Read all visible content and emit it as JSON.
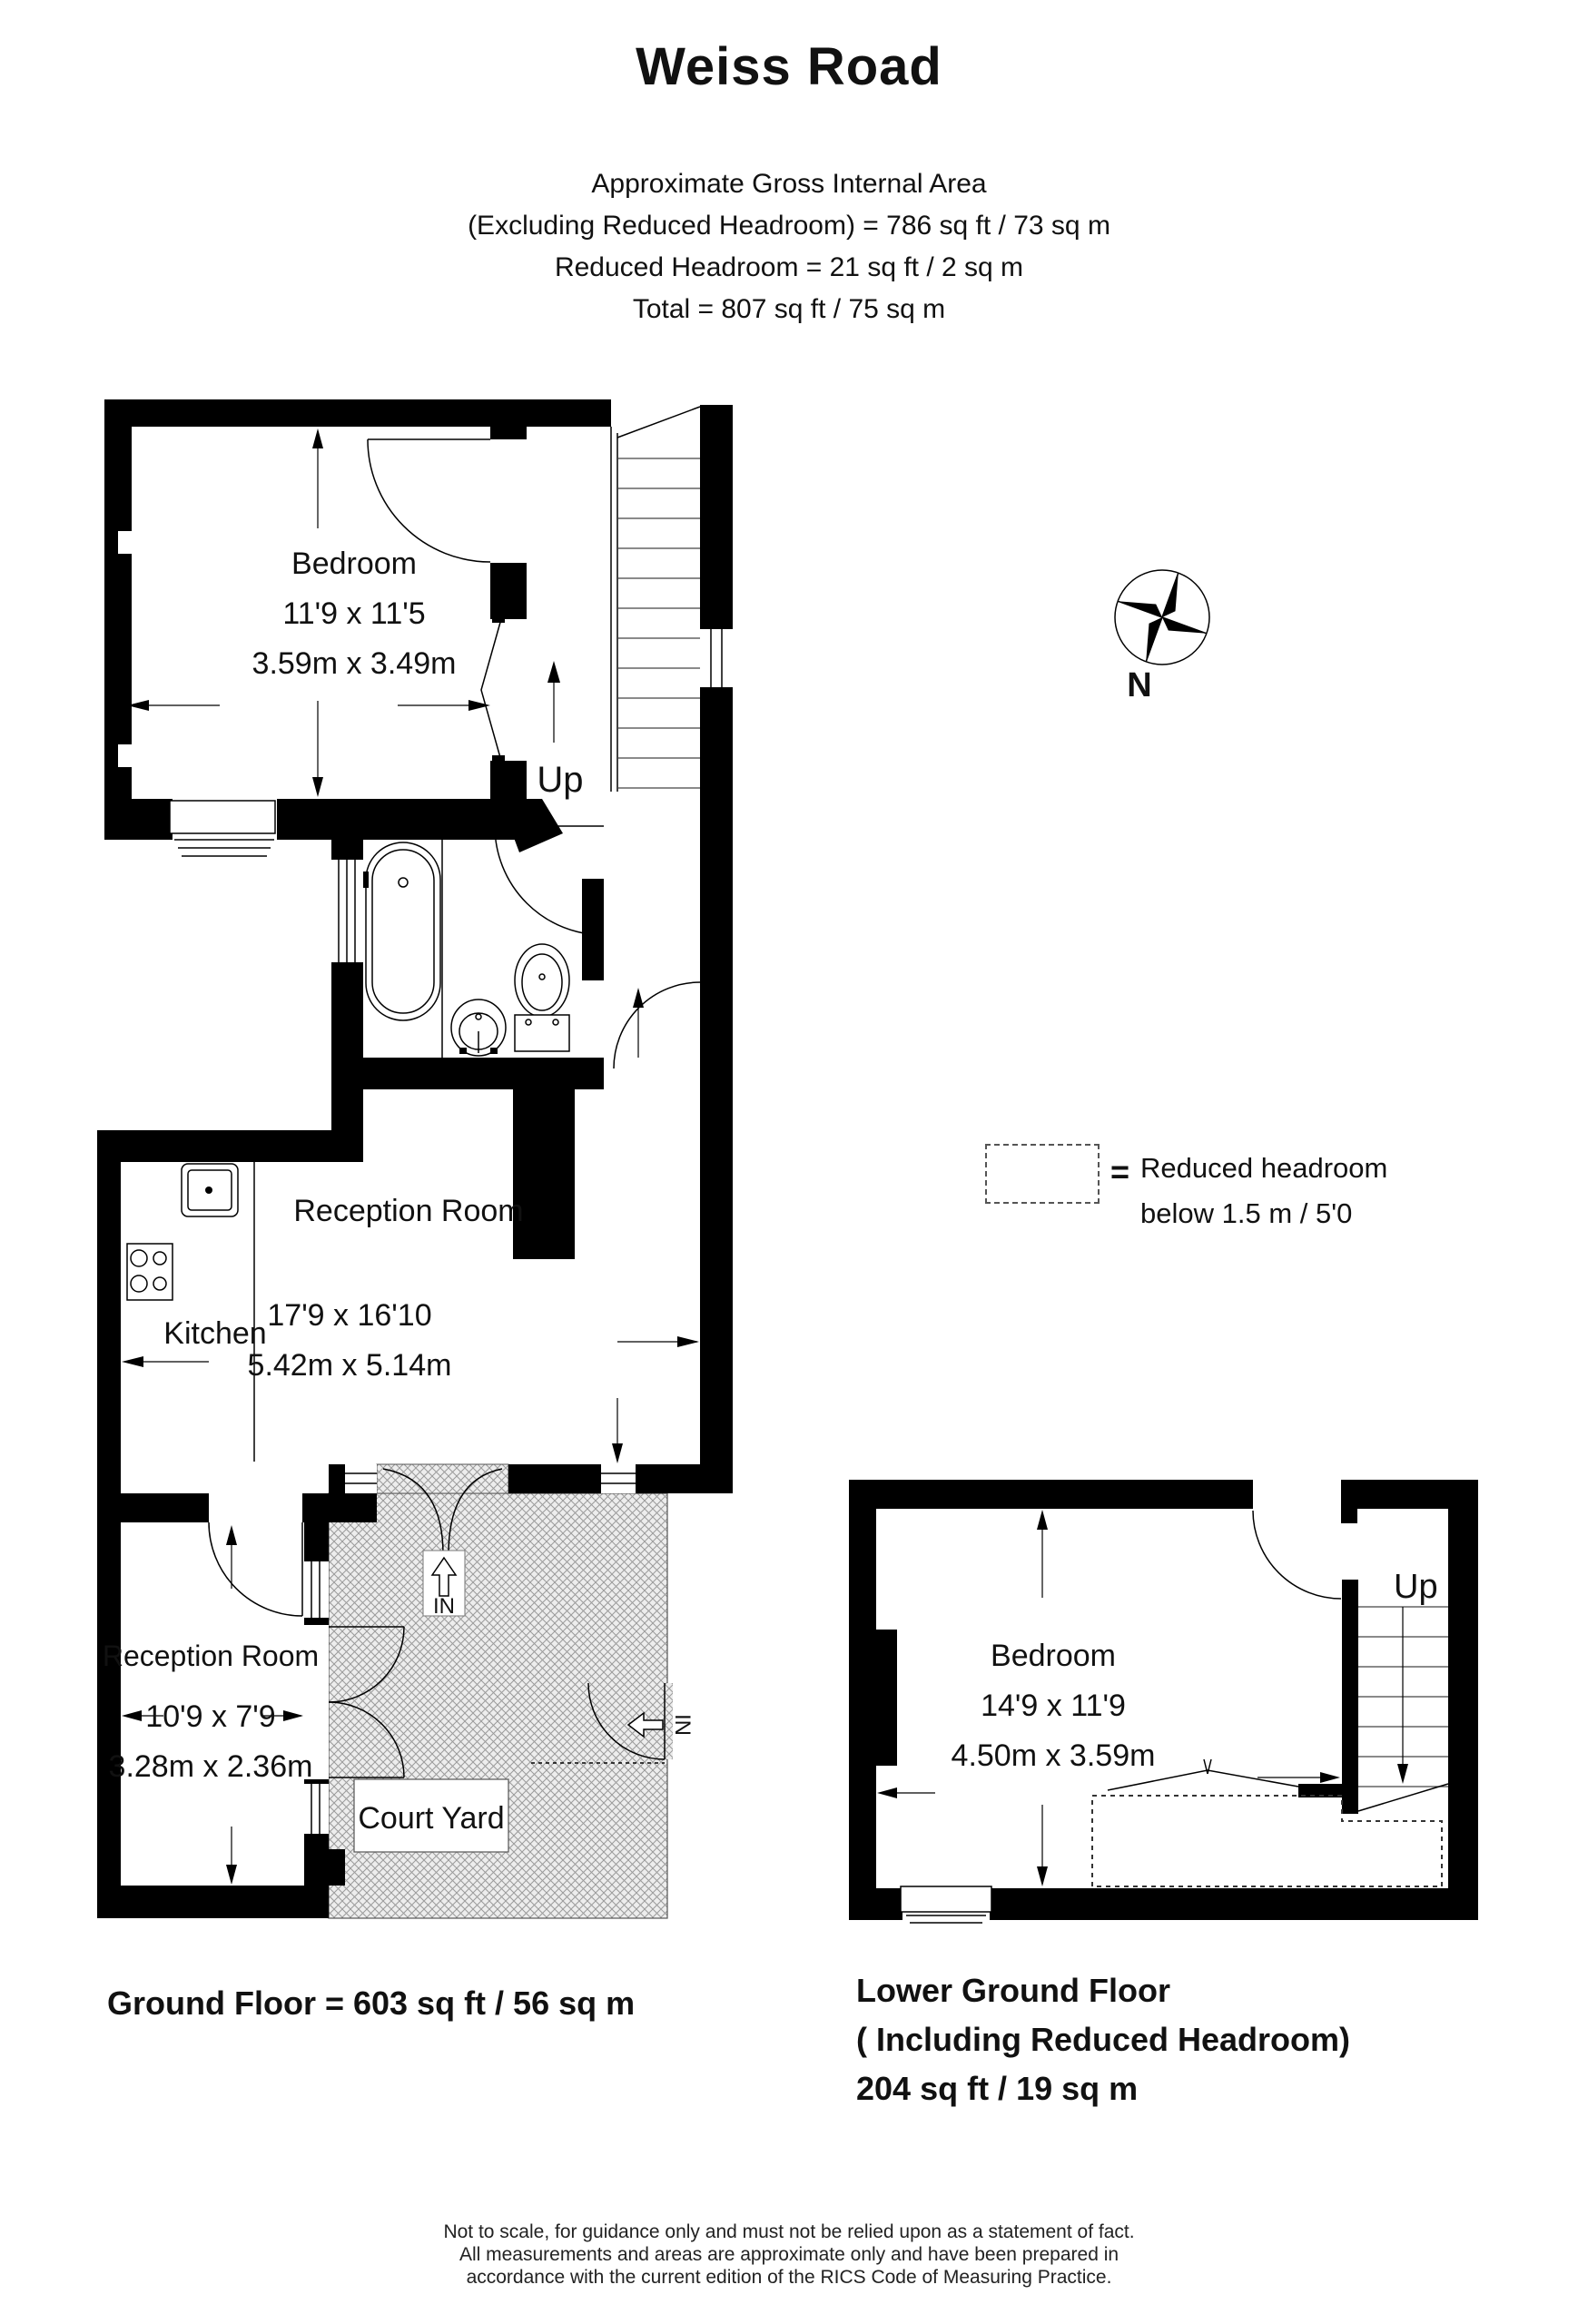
{
  "header": {
    "title": "Weiss Road",
    "area_lines": [
      "Approximate Gross Internal Area",
      "(Excluding Reduced Headroom) = 786 sq ft / 73 sq m",
      "Reduced Headroom = 21 sq ft / 2 sq m",
      "Total = 807 sq ft / 75 sq m"
    ]
  },
  "compass": {
    "north_label": "N"
  },
  "legend": {
    "equals": "=",
    "line1": "Reduced headroom",
    "line2": "below 1.5 m / 5'0"
  },
  "ground_floor": {
    "bedroom": {
      "name": "Bedroom",
      "imperial": "11'9 x 11'5",
      "metric": "3.59m x 3.49m"
    },
    "stairs_label": "Up",
    "reception": {
      "name": "Reception Room",
      "imperial": "17'9 x 16'10",
      "metric": "5.42m x 5.14m"
    },
    "kitchen": {
      "name": "Kitchen"
    },
    "reception2": {
      "name": "Reception Room",
      "imperial": "10'9 x 7'9",
      "metric": "3.28m x 2.36m"
    },
    "courtyard": {
      "name": "Court Yard"
    },
    "entrance_front": "IN",
    "entrance_side": "IN",
    "floor_label": "Ground Floor = 603 sq ft / 56 sq m"
  },
  "lower_ground_floor": {
    "bedroom": {
      "name": "Bedroom",
      "imperial": "14'9 x 11'9",
      "metric": "4.50m x 3.59m"
    },
    "stairs_label": "Up",
    "floor_label_lines": [
      "Lower Ground Floor",
      "( Including Reduced Headroom)",
      "204 sq ft / 19 sq m"
    ]
  },
  "footer": {
    "lines": [
      "Not to scale, for guidance only and must not be relied upon as a statement of fact.",
      "All measurements and areas are approximate only and have been prepared in",
      "accordance with the current edition of the RICS Code of Measuring Practice."
    ]
  },
  "colors": {
    "wall": "#000000",
    "background": "#ffffff",
    "hatch": "#9a9a9a",
    "text": "#111111"
  }
}
